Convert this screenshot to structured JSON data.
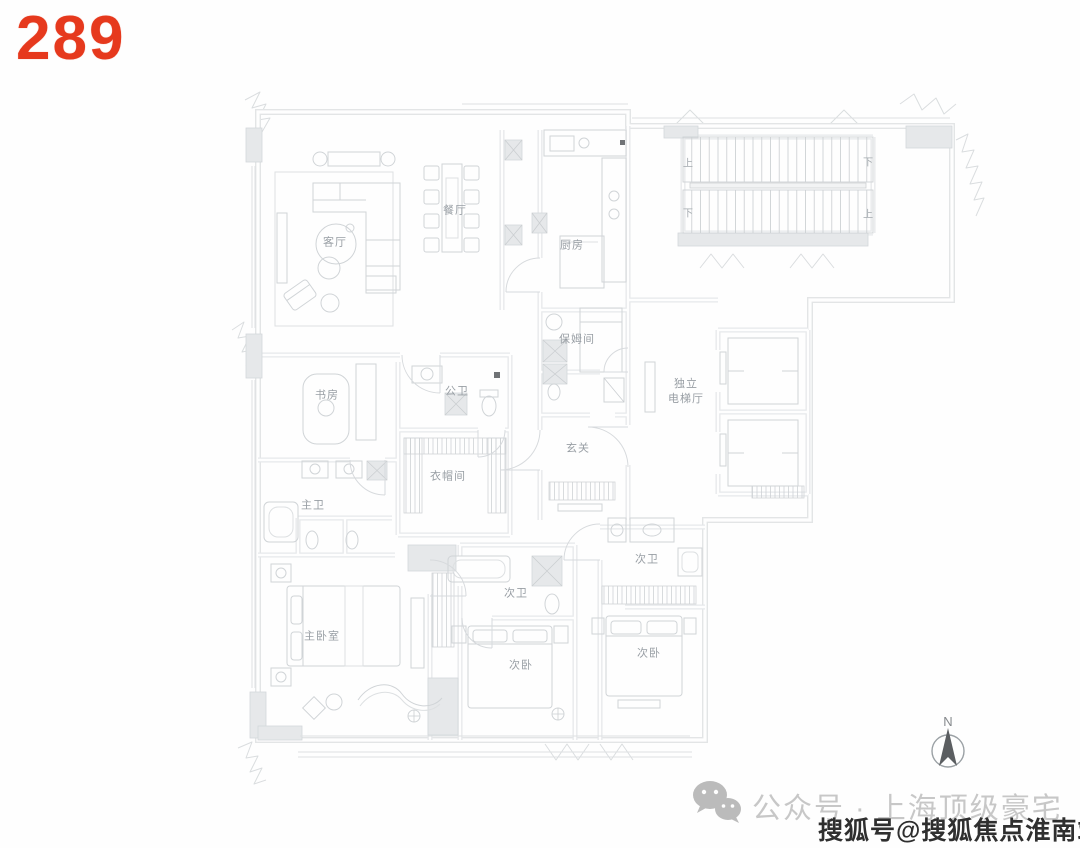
{
  "page": {
    "unit_number": "289",
    "accent_color": "#e6391d",
    "background_color": "#fefefe",
    "plan_line_color": "#cdd1d4",
    "label_color": "#989ea4"
  },
  "floor_plan": {
    "rooms": [
      {
        "id": "living-room",
        "label": "客厅",
        "x": 335,
        "y": 243
      },
      {
        "id": "dining-room",
        "label": "餐厅",
        "x": 455,
        "y": 211
      },
      {
        "id": "kitchen",
        "label": "厨房",
        "x": 572,
        "y": 246
      },
      {
        "id": "nanny-room",
        "label": "保姆间",
        "x": 577,
        "y": 340
      },
      {
        "id": "elevator-hall",
        "label": "独立\n电梯厅",
        "x": 686,
        "y": 392
      },
      {
        "id": "foyer",
        "label": "玄关",
        "x": 578,
        "y": 449
      },
      {
        "id": "study",
        "label": "书房",
        "x": 327,
        "y": 396
      },
      {
        "id": "guest-bathroom",
        "label": "公卫",
        "x": 457,
        "y": 392
      },
      {
        "id": "walk-in-closet",
        "label": "衣帽间",
        "x": 448,
        "y": 477
      },
      {
        "id": "master-bathroom",
        "label": "主卫",
        "x": 313,
        "y": 506
      },
      {
        "id": "master-bedroom",
        "label": "主卧室",
        "x": 322,
        "y": 637
      },
      {
        "id": "bathroom-2",
        "label": "次卫",
        "x": 516,
        "y": 594
      },
      {
        "id": "bedroom-2",
        "label": "次卧",
        "x": 521,
        "y": 666
      },
      {
        "id": "bathroom-3",
        "label": "次卫",
        "x": 647,
        "y": 560
      },
      {
        "id": "bedroom-3",
        "label": "次卧",
        "x": 649,
        "y": 654
      }
    ],
    "stair_labels": [
      {
        "text": "上",
        "x": 688,
        "y": 162
      },
      {
        "text": "下",
        "x": 868,
        "y": 161
      },
      {
        "text": "下",
        "x": 688,
        "y": 212
      },
      {
        "text": "上",
        "x": 868,
        "y": 213
      }
    ],
    "compass": {
      "label": "N"
    }
  },
  "watermarks": {
    "wechat_icon": "wechat-icon",
    "wechat_text": "公众号 · 上海顶级豪宅",
    "sohu_text": "搜狐号@搜狐焦点淮南站"
  }
}
